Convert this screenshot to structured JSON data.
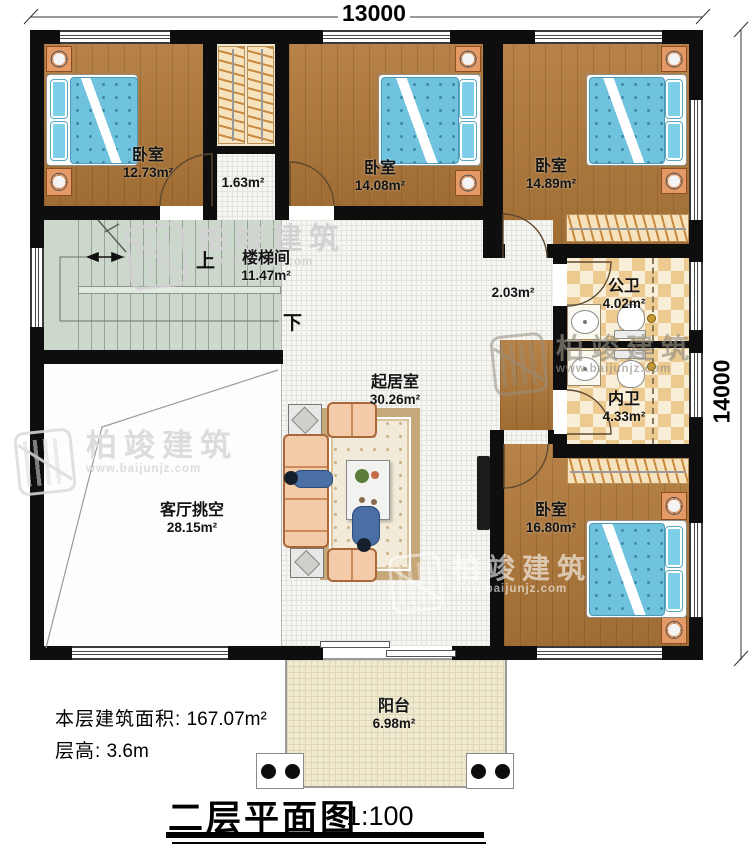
{
  "dimensions": {
    "top": "13000",
    "right": "14000"
  },
  "rooms": {
    "bedroom_top_left": {
      "name": "卧室",
      "area": "12.73m²"
    },
    "inner_hall": {
      "area": "1.63m²"
    },
    "bedroom_top_middle": {
      "name": "卧室",
      "area": "14.08m²"
    },
    "bedroom_top_right": {
      "name": "卧室",
      "area": "14.89m²"
    },
    "stair_hall": {
      "name": "楼梯间",
      "area": "11.47m²",
      "up": "上",
      "down": "下"
    },
    "corridor": {
      "area": "2.03m²"
    },
    "public_bathroom": {
      "name": "公卫",
      "area": "4.02m²"
    },
    "private_bathroom": {
      "name": "内卫",
      "area": "4.33m²"
    },
    "living_room": {
      "name": "起居室",
      "area": "30.26m²"
    },
    "living_void": {
      "name": "客厅挑空",
      "area": "28.15m²"
    },
    "bedroom_bottom_right": {
      "name": "卧室",
      "area": "16.80m²"
    },
    "balcony": {
      "name": "阳台",
      "area": "6.98m²"
    }
  },
  "notes": {
    "floor_area_label": "本层建筑面积:",
    "floor_area_value": "167.07m²",
    "storey_height_label": "层高:",
    "storey_height_value": "3.6m"
  },
  "title": {
    "name": "二层平面图",
    "scale": "1:100"
  },
  "watermark": {
    "brand": "柏竣建筑",
    "website": "www.baijunjz.com"
  },
  "colors": {
    "wall": "#0e0e0e",
    "wood_floor": "#b1793a",
    "stair_floor": "#cdd8cc",
    "bed_quilt": "#70c3de",
    "bathroom_tile": "#ecca90",
    "balcony_floor": "#efe9d0",
    "furniture_accent": "#e59a66"
  }
}
